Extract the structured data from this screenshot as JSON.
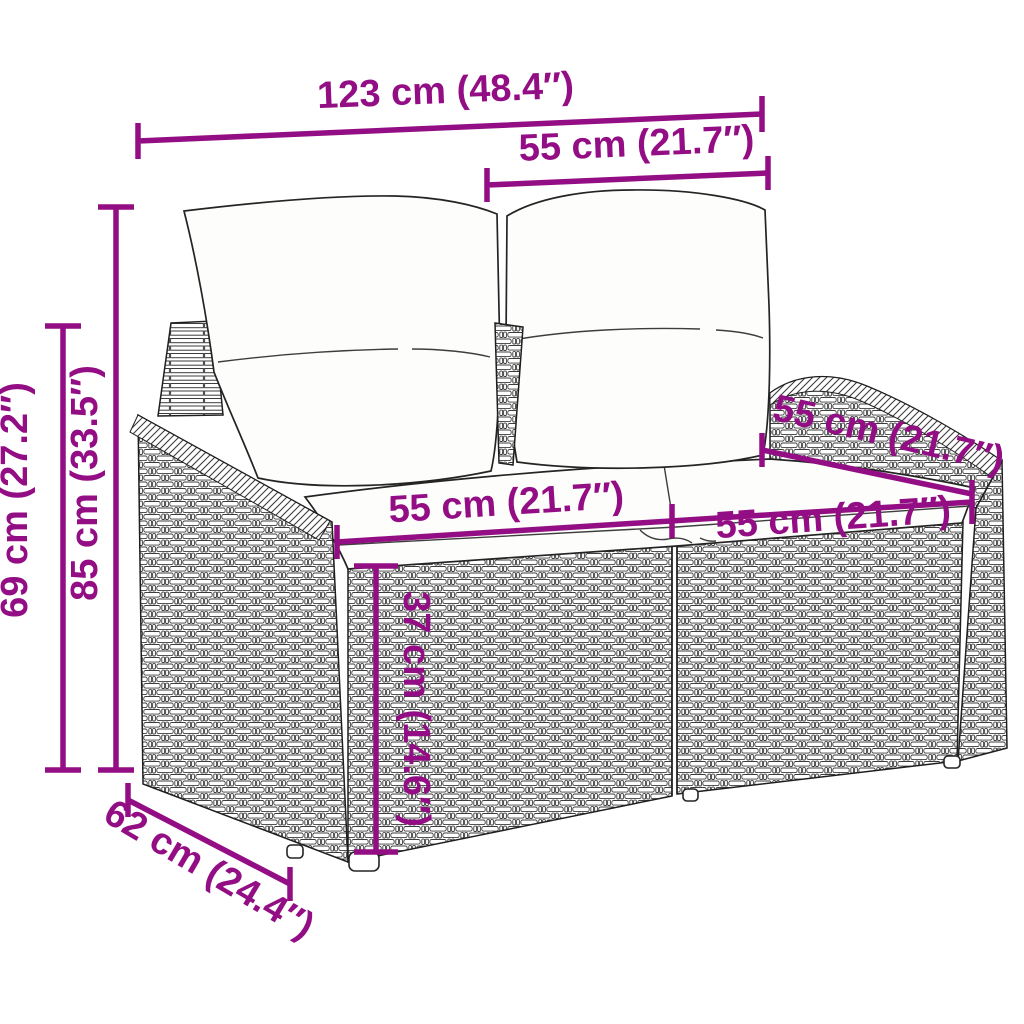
{
  "page": {
    "kind": "product-dimension-diagram",
    "subject": "Two-seater poly rattan garden sofa with back and seat cushions, line-art style",
    "background_color": "#ffffff"
  },
  "style": {
    "dimension_color": "#930e84",
    "art_line_color": "#1f1f1f",
    "cushion_fill": "#fdfdfb"
  },
  "dimensions": {
    "total_width": {
      "label": "123 cm (48.4″)",
      "cm": 123,
      "inches": 48.4
    },
    "back_cushion_width": {
      "label": "55 cm (21.7″)",
      "cm": 55,
      "inches": 21.7
    },
    "total_height": {
      "label": "85 cm (33.5″)",
      "cm": 85,
      "inches": 33.5
    },
    "armrest_height": {
      "label": "69 cm (27.2″)",
      "cm": 69,
      "inches": 27.2
    },
    "seat_width_left": {
      "label": "55 cm (21.7″)",
      "cm": 55,
      "inches": 21.7
    },
    "seat_width_right": {
      "label": "55 cm (21.7″)",
      "cm": 55,
      "inches": 21.7
    },
    "seat_depth": {
      "label": "55 cm (21.7″)",
      "cm": 55,
      "inches": 21.7
    },
    "seat_height": {
      "label": "37 cm (14.6″)",
      "cm": 37,
      "inches": 14.6
    },
    "total_depth": {
      "label": "62 cm (24.4″)",
      "cm": 62,
      "inches": 24.4
    }
  }
}
